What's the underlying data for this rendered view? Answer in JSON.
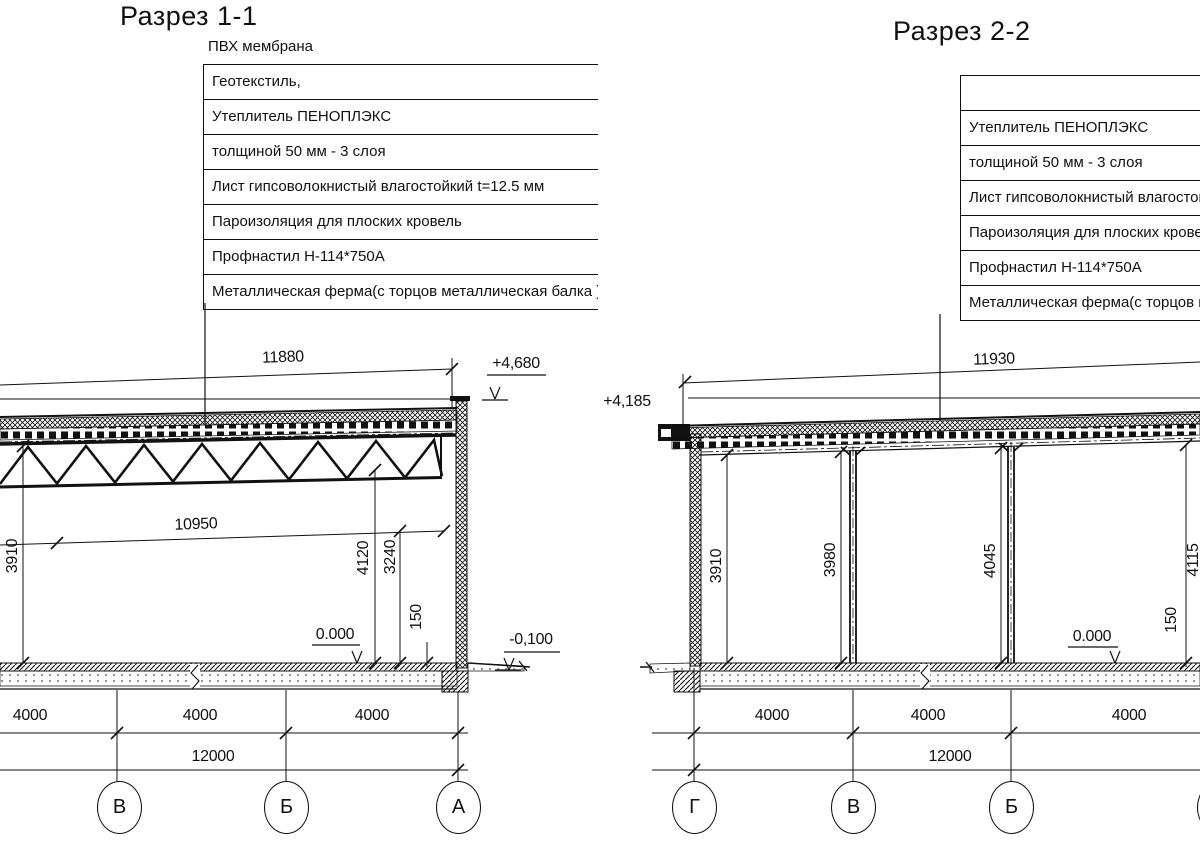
{
  "sections": {
    "s1": {
      "title": "Разрез 1-1",
      "roof_label": "ПВХ мембрана",
      "callouts": [
        "Геотекстиль,",
        "Утеплитель ПЕНОПЛЭКС",
        "толщиной 50 мм - 3 слоя",
        "Лист гипсоволокнистый влагостойкий t=12.5 мм",
        "Пароизоляция для плоских кровель",
        "Профнастил Н-114*750А",
        "Металлическая ферма(с торцов металлическая балка )"
      ],
      "dim_top": "11880",
      "dim_truss": "10950",
      "elev_roof": "+4,680",
      "elev_zero": "0.000",
      "elev_ground": "-0,100",
      "v_dims": [
        "3910",
        "4120",
        "3240",
        "150"
      ],
      "bays": [
        "4000",
        "4000",
        "4000"
      ],
      "total": "12000",
      "axes": [
        "В",
        "Б",
        "А"
      ]
    },
    "s2": {
      "title": "Разрез 2-2",
      "callouts": [
        "",
        "Утеплитель ПЕНОПЛЭКС",
        "толщиной 50 мм - 3 слоя",
        "Лист гипсоволокнистый влагостойкий t=12.5 мм",
        "Пароизоляция для плоских кровель",
        "Профнастил Н-114*750А",
        "Металлическая ферма(с торцов металлическая балка )"
      ],
      "dim_top": "11930",
      "elev_roof": "+4,185",
      "elev_zero": "0.000",
      "v_dims": [
        "3910",
        "3980",
        "4045",
        "4115",
        "150"
      ],
      "bays": [
        "4000",
        "4000",
        "4000"
      ],
      "total": "12000",
      "axes": [
        "Г",
        "В",
        "Б",
        "А"
      ]
    }
  }
}
